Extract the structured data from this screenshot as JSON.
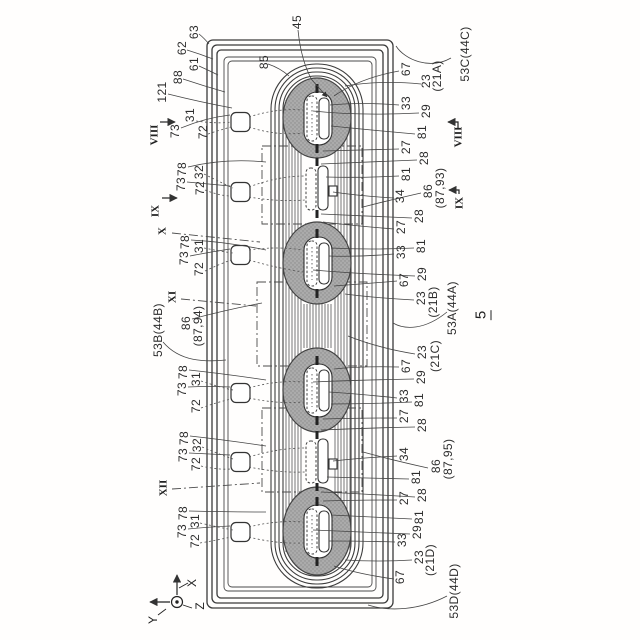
{
  "figure": {
    "number": "5"
  },
  "axes": {
    "x": "X",
    "y": "Y",
    "z": "Z"
  },
  "colors": {
    "line": "#3a3a3a",
    "pole_fill": "#ababab",
    "pole_stipple": "#8a8a8a",
    "label_text": "#2d2d2d",
    "background": "#fffefd"
  },
  "section_markers": [
    {
      "t": "VIII",
      "x": 155,
      "y": 135,
      "side": "left"
    },
    {
      "t": "IX",
      "x": 156,
      "y": 211,
      "side": "left"
    },
    {
      "t": "X",
      "x": 163,
      "y": 231,
      "side": "left"
    },
    {
      "t": "XI",
      "x": 173,
      "y": 297,
      "side": "left"
    },
    {
      "t": "XII",
      "x": 164,
      "y": 488,
      "side": "left"
    },
    {
      "t": "VIII",
      "x": 459,
      "y": 137,
      "side": "right"
    },
    {
      "t": "IX",
      "x": 460,
      "y": 203,
      "side": "right"
    }
  ],
  "ref_labels": [
    {
      "t": "45",
      "x": 297,
      "y": 22
    },
    {
      "t": "63",
      "x": 194,
      "y": 32
    },
    {
      "t": "62",
      "x": 182,
      "y": 48
    },
    {
      "t": "61",
      "x": 194,
      "y": 64
    },
    {
      "t": "88",
      "x": 178,
      "y": 77
    },
    {
      "t": "121",
      "x": 162,
      "y": 92
    },
    {
      "t": "85",
      "x": 264,
      "y": 62
    },
    {
      "t": "73",
      "x": 175,
      "y": 131
    },
    {
      "t": "31",
      "x": 190,
      "y": 115
    },
    {
      "t": "72",
      "x": 203,
      "y": 132
    },
    {
      "t": "78",
      "x": 182,
      "y": 169
    },
    {
      "t": "73",
      "x": 181,
      "y": 184
    },
    {
      "t": "32",
      "x": 199,
      "y": 172
    },
    {
      "t": "72",
      "x": 200,
      "y": 188
    },
    {
      "t": "78",
      "x": 185,
      "y": 242
    },
    {
      "t": "73",
      "x": 184,
      "y": 258
    },
    {
      "t": "31",
      "x": 199,
      "y": 246
    },
    {
      "t": "72",
      "x": 199,
      "y": 269
    },
    {
      "t": "86",
      "x": 186,
      "y": 323
    },
    {
      "t": "(87,94)",
      "x": 198,
      "y": 326
    },
    {
      "t": "53B(44B)",
      "x": 158,
      "y": 330
    },
    {
      "t": "78",
      "x": 183,
      "y": 372
    },
    {
      "t": "73",
      "x": 182,
      "y": 389
    },
    {
      "t": "31",
      "x": 196,
      "y": 379
    },
    {
      "t": "72",
      "x": 196,
      "y": 406
    },
    {
      "t": "78",
      "x": 184,
      "y": 438
    },
    {
      "t": "73",
      "x": 183,
      "y": 455
    },
    {
      "t": "32",
      "x": 197,
      "y": 445
    },
    {
      "t": "72",
      "x": 196,
      "y": 464
    },
    {
      "t": "78",
      "x": 183,
      "y": 513
    },
    {
      "t": "73",
      "x": 182,
      "y": 531
    },
    {
      "t": "31",
      "x": 195,
      "y": 521
    },
    {
      "t": "72",
      "x": 195,
      "y": 541
    },
    {
      "t": "53C(44C)",
      "x": 465,
      "y": 54
    },
    {
      "t": "67",
      "x": 406,
      "y": 69
    },
    {
      "t": "23",
      "x": 426,
      "y": 81
    },
    {
      "t": "(21A)",
      "x": 437,
      "y": 76
    },
    {
      "t": "33",
      "x": 406,
      "y": 103
    },
    {
      "t": "29",
      "x": 426,
      "y": 111
    },
    {
      "t": "81",
      "x": 422,
      "y": 132
    },
    {
      "t": "27",
      "x": 406,
      "y": 147
    },
    {
      "t": "28",
      "x": 424,
      "y": 158
    },
    {
      "t": "81",
      "x": 406,
      "y": 174
    },
    {
      "t": "34",
      "x": 400,
      "y": 196
    },
    {
      "t": "86",
      "x": 428,
      "y": 191
    },
    {
      "t": "(87,93)",
      "x": 440,
      "y": 188
    },
    {
      "t": "28",
      "x": 419,
      "y": 216
    },
    {
      "t": "27",
      "x": 401,
      "y": 227
    },
    {
      "t": "81",
      "x": 421,
      "y": 246
    },
    {
      "t": "33",
      "x": 401,
      "y": 252
    },
    {
      "t": "29",
      "x": 422,
      "y": 274
    },
    {
      "t": "67",
      "x": 404,
      "y": 280
    },
    {
      "t": "23",
      "x": 421,
      "y": 298
    },
    {
      "t": "(21B)",
      "x": 433,
      "y": 302
    },
    {
      "t": "53A(44A)",
      "x": 452,
      "y": 308
    },
    {
      "t": "23",
      "x": 422,
      "y": 352
    },
    {
      "t": "(21C)",
      "x": 435,
      "y": 356
    },
    {
      "t": "67",
      "x": 406,
      "y": 366
    },
    {
      "t": "29",
      "x": 421,
      "y": 377
    },
    {
      "t": "33",
      "x": 404,
      "y": 396
    },
    {
      "t": "81",
      "x": 419,
      "y": 400
    },
    {
      "t": "27",
      "x": 404,
      "y": 416
    },
    {
      "t": "28",
      "x": 422,
      "y": 425
    },
    {
      "t": "34",
      "x": 404,
      "y": 454
    },
    {
      "t": "86",
      "x": 436,
      "y": 466
    },
    {
      "t": "(87,95)",
      "x": 448,
      "y": 459
    },
    {
      "t": "81",
      "x": 416,
      "y": 477
    },
    {
      "t": "28",
      "x": 422,
      "y": 495
    },
    {
      "t": "27",
      "x": 404,
      "y": 498
    },
    {
      "t": "81",
      "x": 419,
      "y": 517
    },
    {
      "t": "29",
      "x": 417,
      "y": 532
    },
    {
      "t": "33",
      "x": 402,
      "y": 540
    },
    {
      "t": "23",
      "x": 419,
      "y": 557
    },
    {
      "t": "(21D)",
      "x": 430,
      "y": 560
    },
    {
      "t": "67",
      "x": 400,
      "y": 577
    },
    {
      "t": "53D(44D)",
      "x": 454,
      "y": 591
    }
  ]
}
